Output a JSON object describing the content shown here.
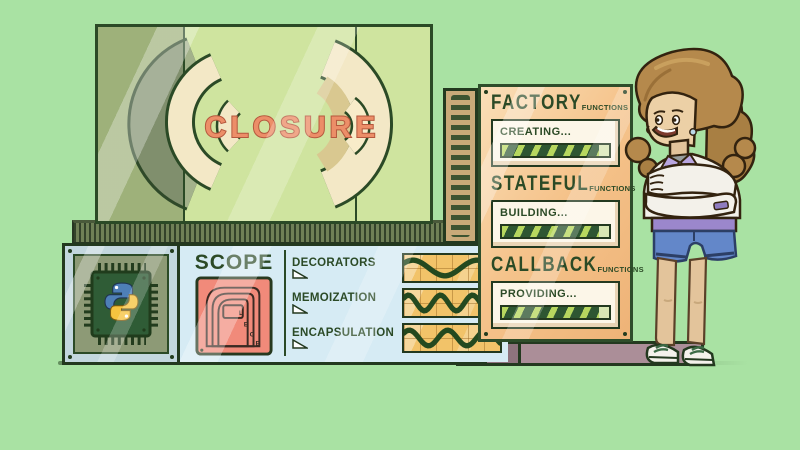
{
  "illustration": "python-closure-machine",
  "palette": {
    "background": "#a9e2a3",
    "outline_green": "#2b4a26",
    "screen_green": "#cfe49f",
    "title_coral": "#ec8e68",
    "panel_orange": "#f5c38b",
    "panel_blue": "#d6ebf4",
    "scope_red": "#f18a7a",
    "bar_dark": "#2e5632",
    "bar_stripe": "#b7d75f",
    "wave_amber": "#f2c369",
    "base_mauve": "#ab8e98"
  },
  "screen": {
    "title": "CLOSURE",
    "decoration": "parentheses-arcs"
  },
  "machine_panel": {
    "sections": [
      {
        "title": "FACTORY",
        "subtitle": "FUNCTIONS",
        "status": "CREATING...",
        "progress": 91
      },
      {
        "title": "STATEFUL",
        "subtitle": "FUNCTIONS",
        "status": "BUILDING...",
        "progress": 91
      },
      {
        "title": "CALLBACK",
        "subtitle": "FUNCTIONS",
        "status": "PROVIDING...",
        "progress": 91
      }
    ]
  },
  "console": {
    "scope_label": "SCOPE",
    "legb_letters": [
      "L",
      "E",
      "G",
      "B"
    ],
    "chip_icon": "python-logo",
    "rows": [
      {
        "label": "DECORATORS",
        "wave_cycles": 1.5
      },
      {
        "label": "MEMOIZATION",
        "wave_cycles": 3
      },
      {
        "label": "ENCAPSULATION",
        "wave_cycles": 2.5
      }
    ]
  },
  "character": {
    "description": "woman-arms-crossed"
  }
}
